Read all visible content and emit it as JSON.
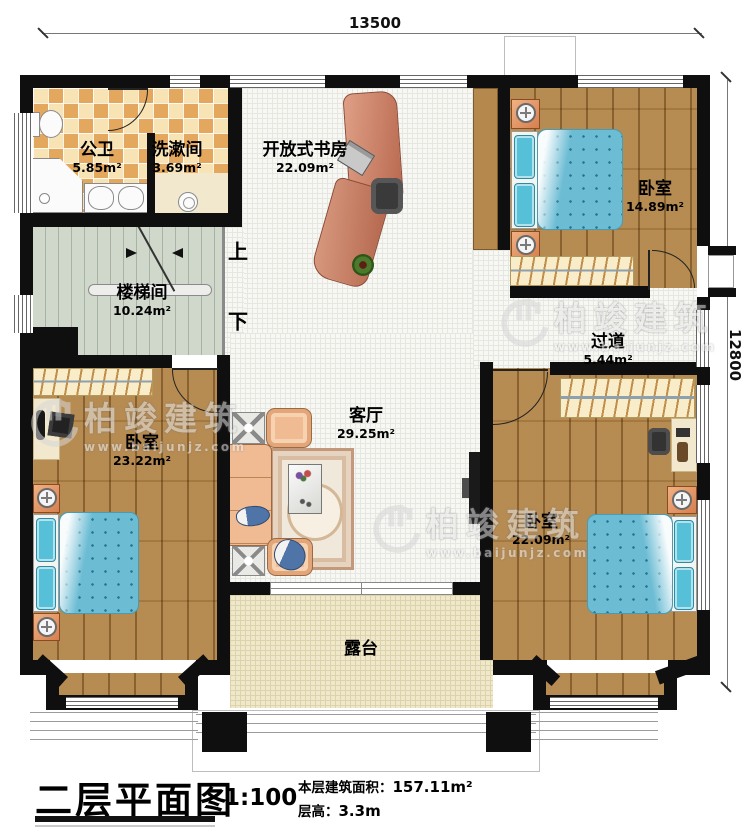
{
  "dimensions": {
    "width": "13500",
    "height": "12800"
  },
  "rooms": [
    {
      "name": "公卫",
      "area": "5.85m²"
    },
    {
      "name": "洗漱间",
      "area": "3.69m²"
    },
    {
      "name": "开放式书房",
      "area": "22.09m²"
    },
    {
      "name": "卧室",
      "area": "14.89m²"
    },
    {
      "name": "楼梯间",
      "area": "10.24m²"
    },
    {
      "name": "过道",
      "area": "5.44m²"
    },
    {
      "name": "卧室",
      "area": "23.22m²"
    },
    {
      "name": "客厅",
      "area": "29.25m²"
    },
    {
      "name": "卧室",
      "area": "22.09m²"
    },
    {
      "name": "露台"
    }
  ],
  "stairs": {
    "up": "上",
    "down": "下"
  },
  "watermark": {
    "brand": "柏竣建筑",
    "url": "www.baijunjz.com"
  },
  "title_block": {
    "title": "二层平面图",
    "scale": "1:100",
    "area_label": "本层建筑面积：",
    "area_value": "157.11m²",
    "height_label": "层高：",
    "height_value": "3.3m"
  }
}
